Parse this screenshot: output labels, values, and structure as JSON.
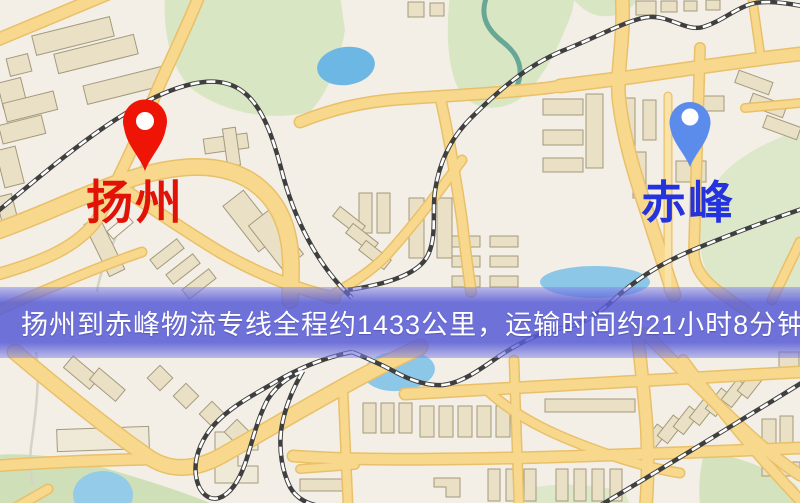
{
  "map": {
    "type": "road-map",
    "origin_marker": {
      "label": "扬州",
      "pin_color": "#ee1506",
      "label_color": "#e01306"
    },
    "destination_marker": {
      "label": "赤峰",
      "pin_color": "#5c8ceb",
      "label_color": "#2433dd"
    },
    "banner": {
      "text": "扬州到赤峰物流专线全程约1433公里，运输时间约21小时8分钟.",
      "text_color": "#ffffff",
      "overlay_color": "#585cd6"
    },
    "route_info": {
      "origin": "扬州",
      "destination": "赤峰",
      "distance_km": 1433,
      "duration_hours": 21,
      "duration_minutes": 8
    },
    "legend_colors": {
      "land": "#f4efe6",
      "road_fill": "#f7d88c",
      "road_casing": "#e9c06a",
      "railway": "#3f3f3f",
      "park_green": "#d9e6c4",
      "water_blue": "#85c3e6",
      "building": "#e9e0c6"
    }
  }
}
